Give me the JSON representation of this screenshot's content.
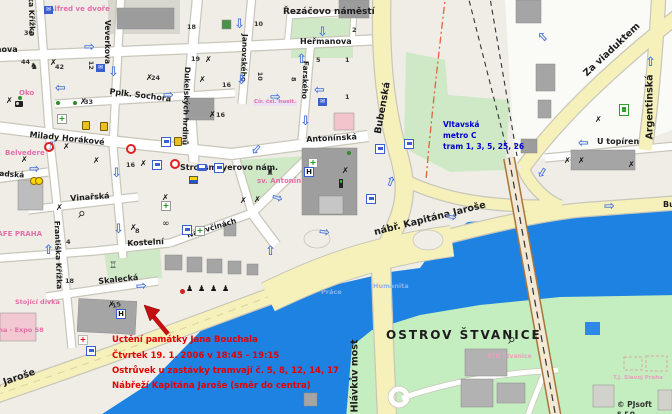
{
  "copyright": "© PJsoft s.r.o.",
  "event_note": {
    "line1": "Uctění památky Jana Bouchala",
    "line2": "Čtvrtek 19. 1. 2006 v 18:45 - 19:15",
    "line3": "Ostrůvek u zastávky tramvají č. 5, 8, 12, 14, 17",
    "line4": "Nábřeží Kapitána Jaroše (směr do centra)"
  },
  "transit_station": {
    "name": "Vltavská",
    "metro": "metro C",
    "trams": "tram 1, 3, 5, 25, 26"
  },
  "streets": {
    "rezacovo_namesti": "Řezáčovo náměstí",
    "hermanova": "Heřmanova",
    "pplk_sochora": "Pplk. Sochora",
    "milady_horakove": "Milady Horákové",
    "antoninska": "Antonínská",
    "veverkova": "Veverkova",
    "janovskeho": "Janovského",
    "farskeho": "Farského",
    "dukelskych_hrdinu": "Dukelských hrdinů",
    "frantiska_krizka": "Františka Křížka",
    "letohradska": "Letohradská",
    "vinarska": "Vinařská",
    "kostelni": "Kostelní",
    "na_ovcinach": "Na ovčinách",
    "skalecka": "Skalecká",
    "bubenska": "Bubenská",
    "za_viaduktem": "Za viaduktem",
    "argentinska": "Argentinská",
    "u_topiren": "U topíren",
    "nabr_kapitana_jarose": "nábř. Kapitána Jaroše",
    "bubenske_nabrezi": "Bubenské nábřeží",
    "hlavkuv_most": "Hlávkův most"
  },
  "places": {
    "ostrov_stvanice": "OSTROV ŠTVANICE",
    "strossmayerovo_nam": "Strossmayerovo nám.",
    "sv_antonin": "sv. Antonín",
    "alfred_ve_dvore": "Alfred ve dvoře",
    "belvedere": "Belvedere",
    "oko": "Oko",
    "kafe_praha": "KAFE PRAHA",
    "stojici_divka": "Stojící dívka",
    "praha_expo_58": "Praha - Expo 58",
    "cirkev_csl_husitska": "Cír. čsl. husit.",
    "std_stvanice": "STD Štvanice",
    "tj_slavoj": "T.J. Slavoj Praha"
  },
  "river_labels": {
    "prace": "Práce",
    "humanita": "Humanita"
  },
  "house_numbers": [
    "30",
    "44",
    "42",
    "33",
    "24",
    "18",
    "19",
    "16",
    "16",
    "10",
    "2",
    "5",
    "1",
    "1",
    "10",
    "8",
    "12",
    "16",
    "4",
    "8",
    "15",
    "18"
  ],
  "icons": {
    "arrow_right": "⇨",
    "arrow_left": "⇦",
    "arrow_up": "⇧",
    "arrow_down": "⇩",
    "restaurant": "✗",
    "pharmacy": "+",
    "hospital": "H",
    "hotel": "H",
    "post": "✉",
    "statue": "♞",
    "monument_figure": "♟",
    "tennis_racket": "⚲",
    "museum": "♖",
    "church": "♜",
    "cyclist": "∞",
    "first_aid": "+"
  },
  "colors": {
    "river": "#1e82e2",
    "major_road": "#f6f1bb",
    "park_green": "#cfe9c6",
    "building_gray": "#a5a5a5",
    "annotation_red": "#e60000",
    "transit_blue": "#0000cc",
    "poi_pink": "#e36fa9",
    "oneway_blue": "#4a74d8"
  }
}
